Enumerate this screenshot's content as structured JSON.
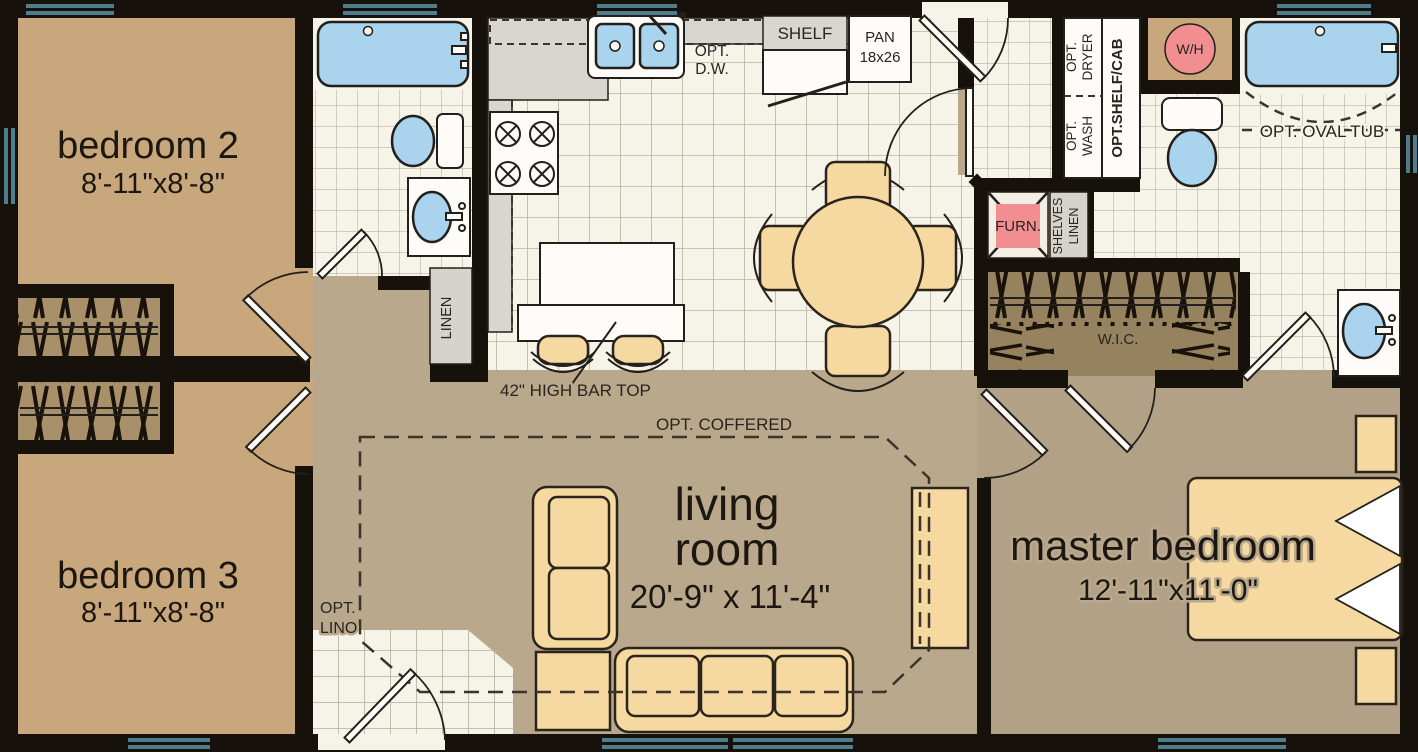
{
  "plan_title": "floor plan",
  "rooms": {
    "bedroom2": {
      "name": "bedroom 2",
      "dims": "8'-11\"x8'-8\""
    },
    "bedroom3": {
      "name": "bedroom 3",
      "dims": "8'-11\"x8'-8\""
    },
    "living_room": {
      "name_l1": "living",
      "name_l2": "room",
      "dims": "20'-9\" x 11'-4\""
    },
    "master_bedroom": {
      "name": "master bedroom",
      "dims": "12'-11\"x11'-0\""
    }
  },
  "labels": {
    "opt_dw": {
      "l1": "OPT.",
      "l2": "D.W."
    },
    "shelf": "SHELF",
    "pan": {
      "l1": "PAN",
      "l2": "18x26"
    },
    "opt_dryer": {
      "l1": "OPT.",
      "l2": "DRYER"
    },
    "opt_wash": {
      "l1": "OPT.",
      "l2": "WASH"
    },
    "opt_shelf_cab": "OPT.SHELF/CAB",
    "water_heater": "W/H",
    "opt_oval_tub": "OPT. OVAL TUB",
    "furnace": "FURN.",
    "shelves_linen": {
      "l1": "SHELVES",
      "l2": "LINEN"
    },
    "wic": "W.I.C.",
    "linen": "LINEN",
    "bar_top": "42\" HIGH BAR TOP",
    "opt_coffered": "OPT. COFFERED",
    "opt_lino": {
      "l1": "OPT.",
      "l2": "LINO"
    }
  },
  "colors": {
    "wall": "#17110b",
    "carpet_bedroom": "#c9a77d",
    "carpet_living": "#b9a88c",
    "carpet_master": "#b3a187",
    "tile": "#f6f3e9",
    "tile_grid": "#bab3a0",
    "counter": "#d8d6cf",
    "closet_brown": "#a8906a",
    "wic_brown": "#96825e",
    "fixture_blue": "#aad3ee",
    "fixture_white": "#fdfcf8",
    "accent_pink": "#f18e92",
    "furniture_tan": "#f6d9a1",
    "window_teal": "#4e7e8e"
  }
}
